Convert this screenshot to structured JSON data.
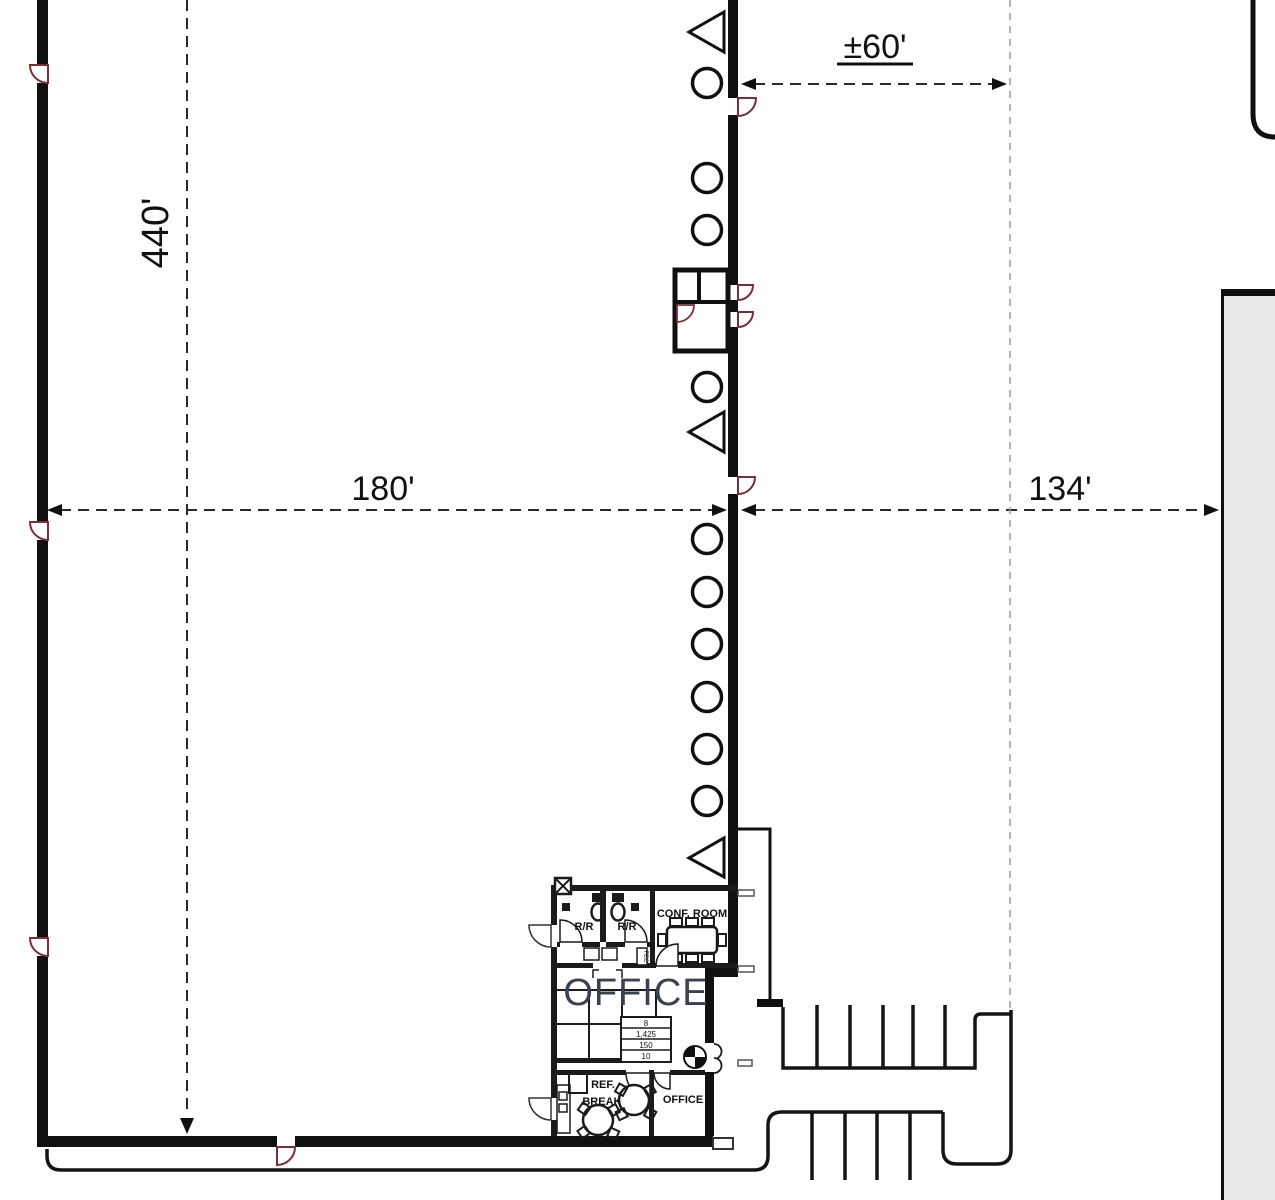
{
  "drawing": {
    "dimensions": {
      "vertical_depth": "440'",
      "width_left": "180'",
      "width_right": "134'",
      "top_offset": "±60'"
    },
    "office": {
      "main_label": "OFFICE",
      "conference_room": "CONF. ROOM",
      "restroom": "R/R",
      "break_room": "BREAK RM",
      "private_office": "OFFICE",
      "refrigerator": "REF.",
      "fire_extinguisher_cabinet": "FEC",
      "area_table_rows": [
        "8",
        "1,425",
        "150",
        "10"
      ]
    },
    "colors": {
      "wall": "#101010",
      "interior_wall": "#1b1b1b",
      "door_swing": "#7b2d38",
      "dimension_line": "#2a2a2a",
      "light_dash": "#9a9a9a",
      "adjacent_building_fill": "#e7e8ea",
      "office_text": "#3a4150"
    }
  }
}
